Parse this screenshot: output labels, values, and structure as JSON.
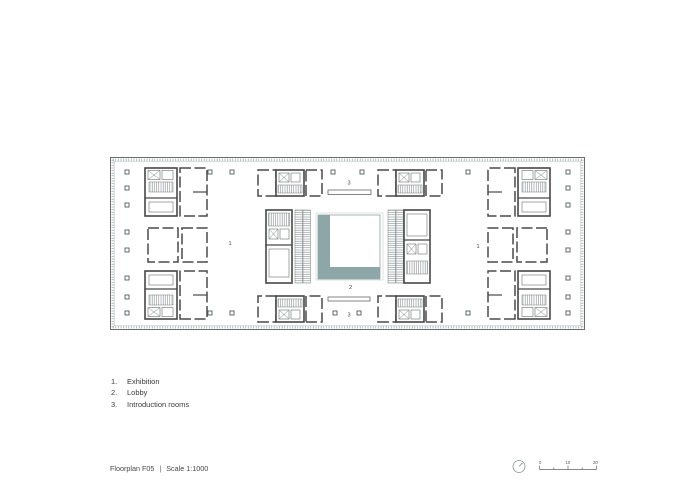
{
  "colors": {
    "accent_teal": "#8da6a7",
    "line_dark": "#474747",
    "line_light": "#9aa3a5",
    "text": "#3a3a3a"
  },
  "plan": {
    "labels": {
      "exhibition_left": "1",
      "exhibition_right": "1",
      "lobby": "2",
      "introduction_top": "3",
      "introduction_bottom": "3"
    }
  },
  "legend": {
    "items": [
      {
        "number": "1.",
        "label": "Exhibition"
      },
      {
        "number": "2.",
        "label": "Lobby"
      },
      {
        "number": "3.",
        "label": "Introduction rooms"
      }
    ]
  },
  "footer": {
    "title": "Floorplan F05",
    "separator": "|",
    "scale_label": "Scale 1:1000",
    "scale_bar": {
      "tick_labels": [
        "0",
        "10",
        "20"
      ]
    }
  }
}
